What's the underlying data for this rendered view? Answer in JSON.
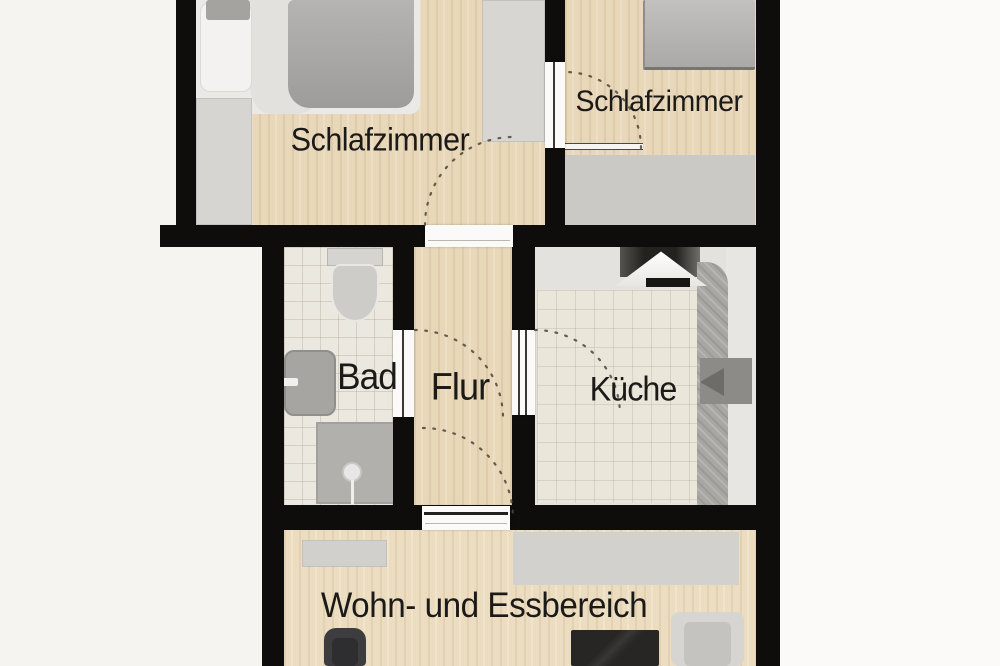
{
  "floorplan": {
    "type": "apartment-floor-plan",
    "rooms": [
      {
        "id": "bedroom-left",
        "label": "Schlafzimmer"
      },
      {
        "id": "bedroom-right",
        "label": "Schlafzimmer"
      },
      {
        "id": "bathroom",
        "label": "Bad"
      },
      {
        "id": "hallway",
        "label": "Flur"
      },
      {
        "id": "kitchen",
        "label": "Küche"
      },
      {
        "id": "living-dining",
        "label": "Wohn- und Essbereich"
      }
    ],
    "colors": {
      "background": "#f5f4f1",
      "wall": "#0e0d0b",
      "wood_floor": "#e8d7b8",
      "tile_floor": "#ebe8df",
      "label_text": "#1b1a18"
    }
  }
}
